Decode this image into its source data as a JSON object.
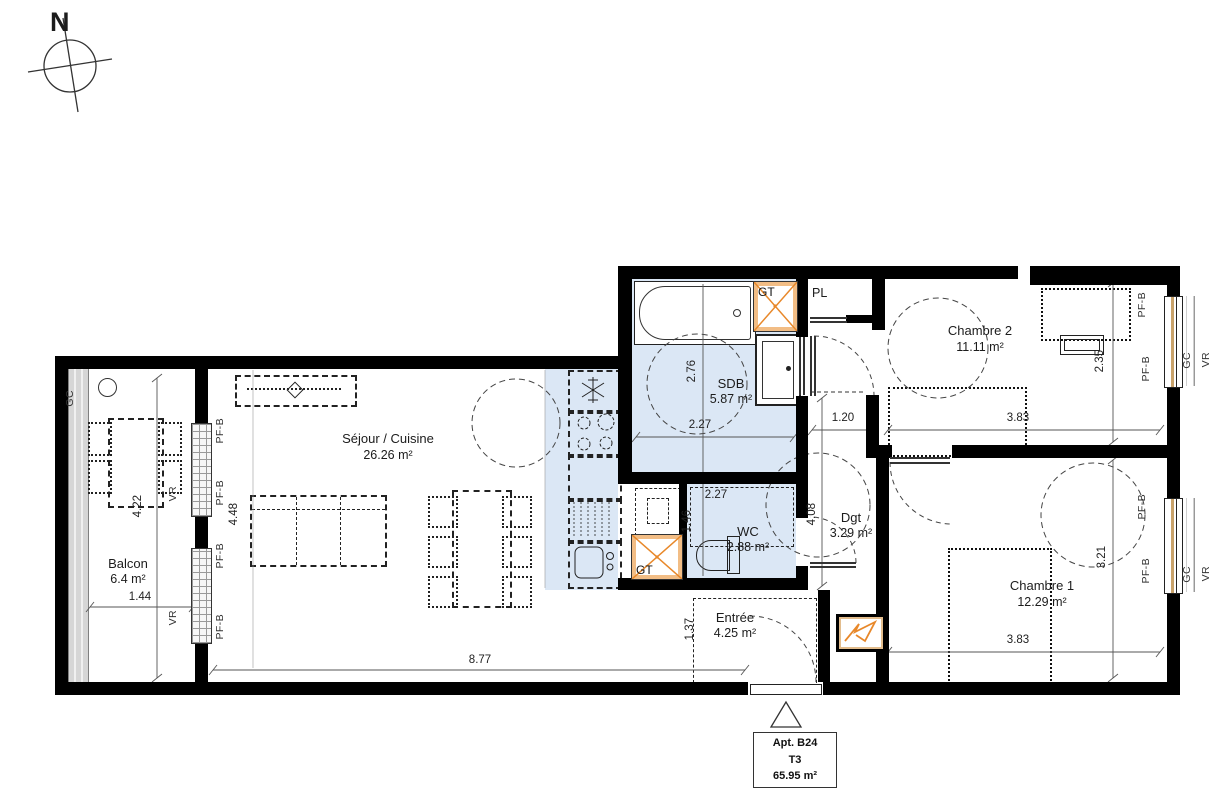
{
  "plan": {
    "compass_n": "N",
    "title_block": {
      "apt": "Apt. B24",
      "type": "T3",
      "area": "65.95 m²"
    },
    "rooms": {
      "sejour": {
        "name": "Séjour / Cuisine",
        "area": "26.26 m²"
      },
      "balcon": {
        "name": "Balcon",
        "area": "6.4 m²"
      },
      "sdb": {
        "name": "SDB",
        "area": "5.87 m²"
      },
      "wc": {
        "name": "WC",
        "area": "2.88 m²"
      },
      "dgt": {
        "name": "Dgt",
        "area": "3.29 m²"
      },
      "entree": {
        "name": "Entrée",
        "area": "4.25 m²"
      },
      "chambre1": {
        "name": "Chambre 1",
        "area": "12.29 m²"
      },
      "chambre2": {
        "name": "Chambre 2",
        "area": "11.11 m²"
      },
      "pl": {
        "name": "PL"
      },
      "gt": {
        "name": "GT"
      }
    },
    "dimensions": {
      "balcon_height": "4.22",
      "balcon_width": "1.44",
      "sejour_sofa_depth": "4.48",
      "sejour_width": "8.77",
      "sdb_height": "2.76",
      "sdb_width": "2.27",
      "wc_width": "2.27",
      "wc_height": "1.46",
      "dgt_height": "4.08",
      "dgt_width": "1.20",
      "entree_height": "1.37",
      "chambre2_width": "3.83",
      "chambre2_height": "2.35",
      "chambre1_width": "3.83",
      "chambre1_height": "3.21"
    },
    "edge_labels": {
      "pfb": "PF-B",
      "vr": "VR",
      "gc": "GC"
    },
    "colors": {
      "wet_room_fill": "#dbe7f5",
      "accent_orange": "#e8882a",
      "wall": "#000000"
    }
  }
}
